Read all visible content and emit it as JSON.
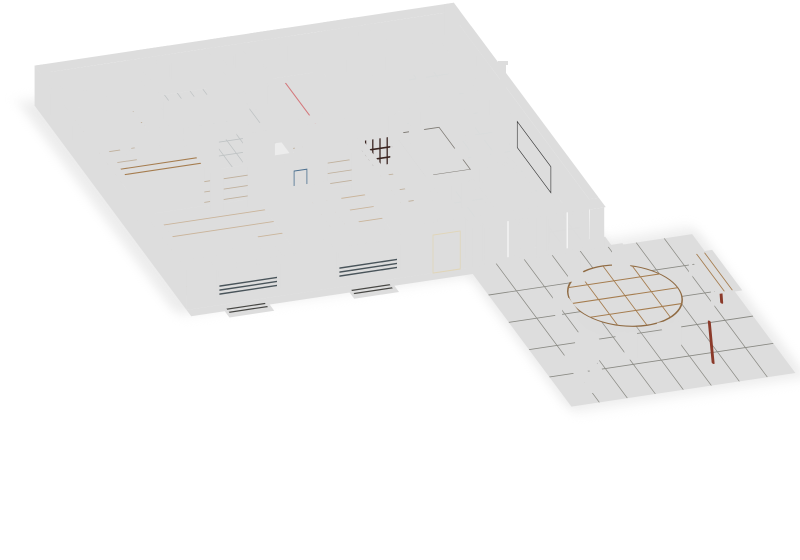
{
  "scene": {
    "type": "3d-floor-plan-render",
    "view": "isometric-dollhouse",
    "background": "#ffffff"
  },
  "rooms": [
    {
      "id": "office",
      "furniture": [
        "cream-sofa",
        "wood-desk",
        "office-chair",
        "wall-planter"
      ]
    },
    {
      "id": "bathroom",
      "furniture": [
        "bathtub",
        "washing-machine",
        "washing-machine"
      ]
    },
    {
      "id": "wc",
      "furniture": [
        "toilet"
      ]
    },
    {
      "id": "master-bedroom",
      "furniture": [
        "pink-double-bed",
        "nightstand",
        "nightstand"
      ]
    },
    {
      "id": "laundry-room",
      "furniture": [
        "tall-cream-cabinet"
      ]
    },
    {
      "id": "entry",
      "furniture": [
        "doormat",
        "doormat",
        "front-door"
      ]
    },
    {
      "id": "kitchen",
      "furniture": [
        "wall-counter",
        "sink-counter",
        "island-with-cooktop",
        "potted-plant",
        "bottles"
      ]
    },
    {
      "id": "dining-area",
      "furniture": [
        "dining-table",
        "six-cream-chairs",
        "wine-cubby-shelf"
      ]
    },
    {
      "id": "living-room",
      "furniture": [
        "tv-screen",
        "curved-tv-console",
        "pellet-stove",
        "gray-rug",
        "gray-armchair",
        "beige-sofa",
        "brown-armchair",
        "potted-plant",
        "sliding-glass-doors"
      ]
    },
    {
      "id": "hallway",
      "furniture": [
        "wood-top-wardrobe"
      ]
    },
    {
      "id": "kids-bedroom-blue",
      "furniture": [
        "blue-cartoon-bed",
        "bedside-table",
        "brown-wardrobe"
      ]
    },
    {
      "id": "kids-bedroom-striped",
      "furniture": [
        "striped-bed",
        "wall-poster"
      ]
    },
    {
      "id": "terrace",
      "furniture": [
        "oval-wood-table",
        "five-wood-chairs",
        "bench-red-legs",
        "bistro-chair",
        "potted-plant",
        "parasol-poles"
      ]
    }
  ],
  "colors": {
    "bg": "#ffffff",
    "shadow": "#cfcdc6",
    "wall_top": "#f0e8d4",
    "wall_top_gray": "#6d7173",
    "wall_top_maroon": "#8d5a52",
    "wall_top_green": "#cfe0c4",
    "wall_top_tile": "#b4babc",
    "face_cream": "#e3d7ba",
    "face_cream2": "#e8d9c2",
    "face_front": "#e6dbbd",
    "face_ext_west": "#ece4d0",
    "face_shade": "#d4c5a2",
    "maroon": "#7d4a43",
    "gray_wall": "#5d6164",
    "gray_wall2": "#666b6e",
    "wc_wall": "#7c8284",
    "tile_wall": "#9fa5a7",
    "tile_wall2": "#a8aeb0",
    "pink_wall": "#e2c4be",
    "pink_wall2": "#e8cac4",
    "frame_white": "#fafaf6",
    "glass": "#9db6ca",
    "glass_dark": "#47525a",
    "shutter": "#5f6a70",
    "door_dark": "#4a4648",
    "slide_glass": "#6f94ae",
    "header_cream": "#f6f4ec",
    "kerb": "#f1efe6",
    "floor_office": "#b59c84",
    "floor_wood": "#c2a382",
    "floor_kids": "#cdab7e",
    "floor_bath": "#a7abad",
    "floor_tile": "#c6cacb",
    "terrace": "#8e8e8a",
    "terrace_dark": "#858580",
    "terrace_light": "#97978f",
    "counter_top": "#8b9093",
    "counter_face": "#5e6264",
    "counter_face2": "#565a5c",
    "island_top": "#6e7274",
    "island_face": "#54585a",
    "island_face2": "#5a5e60",
    "cooktop": "#1b1b1b",
    "steel": "#c2c7c9",
    "steel_dark": "#6d7275",
    "red_accent": "#c0272d",
    "red_accent_dark": "#8c1d22",
    "fridge_top": "#f2ecd8",
    "fridge_face": "#e9e2c8",
    "fridge_side": "#ddd3b4",
    "stove_top": "#43474a",
    "stove_face": "#34383b",
    "stove_face2": "#2f3336",
    "pipe": "#2e3234",
    "console": "#ede4cc",
    "console_face": "#e0d5b8",
    "tv": "#141414",
    "rug": "#b0b4b4",
    "rug_inner": "#a2a6a6",
    "mat_gray": "#9aa0a2",
    "mat_gray2": "#8f9596",
    "table_top": "#8f8a84",
    "table_face": "#7a766f",
    "table_face2": "#807c75",
    "chair_cream": "#dfcf9e",
    "chair_cream_face": "#d6c594",
    "place_brown": "#8a6a4a",
    "shelf_top": "#7d4a3e",
    "shelf_face": "#6e3f34",
    "shelf_side": "#5e352c",
    "armchair": "#b9bdbf",
    "armchair_face": "#a6aaac",
    "armchair_back": "#aaaeb0",
    "sofa_cushion": "#cbbba2",
    "sofa_back": "#a89880",
    "sofa_top": "#b3a38a",
    "cup": "#f4f4f2",
    "brown_chair": "#9b7a5e",
    "brown_chair_face": "#8a6a4e",
    "tub": "#f2f4f4",
    "tub_inner": "#dde2e2",
    "tub_face": "#e8eaea",
    "tub_side": "#dfe3e3",
    "washer": "#3c4042",
    "washer_ring": "#575b5e",
    "knob": "#9aa0a2",
    "toilet": "#f4f6f6",
    "toilet_shade": "#e4e8e8",
    "osofa": "#ead9a8",
    "osofa_hi": "#f2e4bc",
    "osofa_face": "#decd9c",
    "desk": "#b98c5e",
    "desk_face": "#a87c50",
    "chair_dark": "#3c3c3c",
    "art_green": "#4e7e3a",
    "duvet": "#e08a8e",
    "duvet_face": "#d47e82",
    "duvet_side": "#cc7f83",
    "duvet_throw": "#cf7276",
    "pillow_pink": "#efb0b4",
    "headboard": "#a87f52",
    "headboard_face": "#997347",
    "kids_blue": "#3f7dc0",
    "kids_blue_face": "#3668a4",
    "kids_blue_side": "#35679f",
    "kids_pillow": "#8fb4dc",
    "kids_stripe_mid": "#4e8f4a",
    "side_table": "#8e9496",
    "side_table_face": "#7d8385",
    "stripe_green": "#5c8f55",
    "stripe_tan": "#d8b36a",
    "stripe_blue": "#a8cbe0",
    "kids2_face": "#c2a261",
    "kids2_side": "#4e7a49",
    "pillow_white": "#eef0ee",
    "poster": "#d8e4ec",
    "wardrobe": "#8a6a52",
    "wood_top": "#c9a273",
    "t_wood": "#b98f62",
    "t_wood_dark": "#8f6a42",
    "leg_red": "#8b3a2a",
    "bistro": "#46494b",
    "plant": "#5a9a22",
    "plant_hi": "#7ab82e",
    "pot": "#7b4b2e",
    "pot_face": "#6b3f26",
    "vent": "#5c5c58",
    "dot_white": "#e8e8e8",
    "dot_red": "#d03a3a",
    "dot_dark": "#222222",
    "dot_yellow": "#e8c83a"
  }
}
